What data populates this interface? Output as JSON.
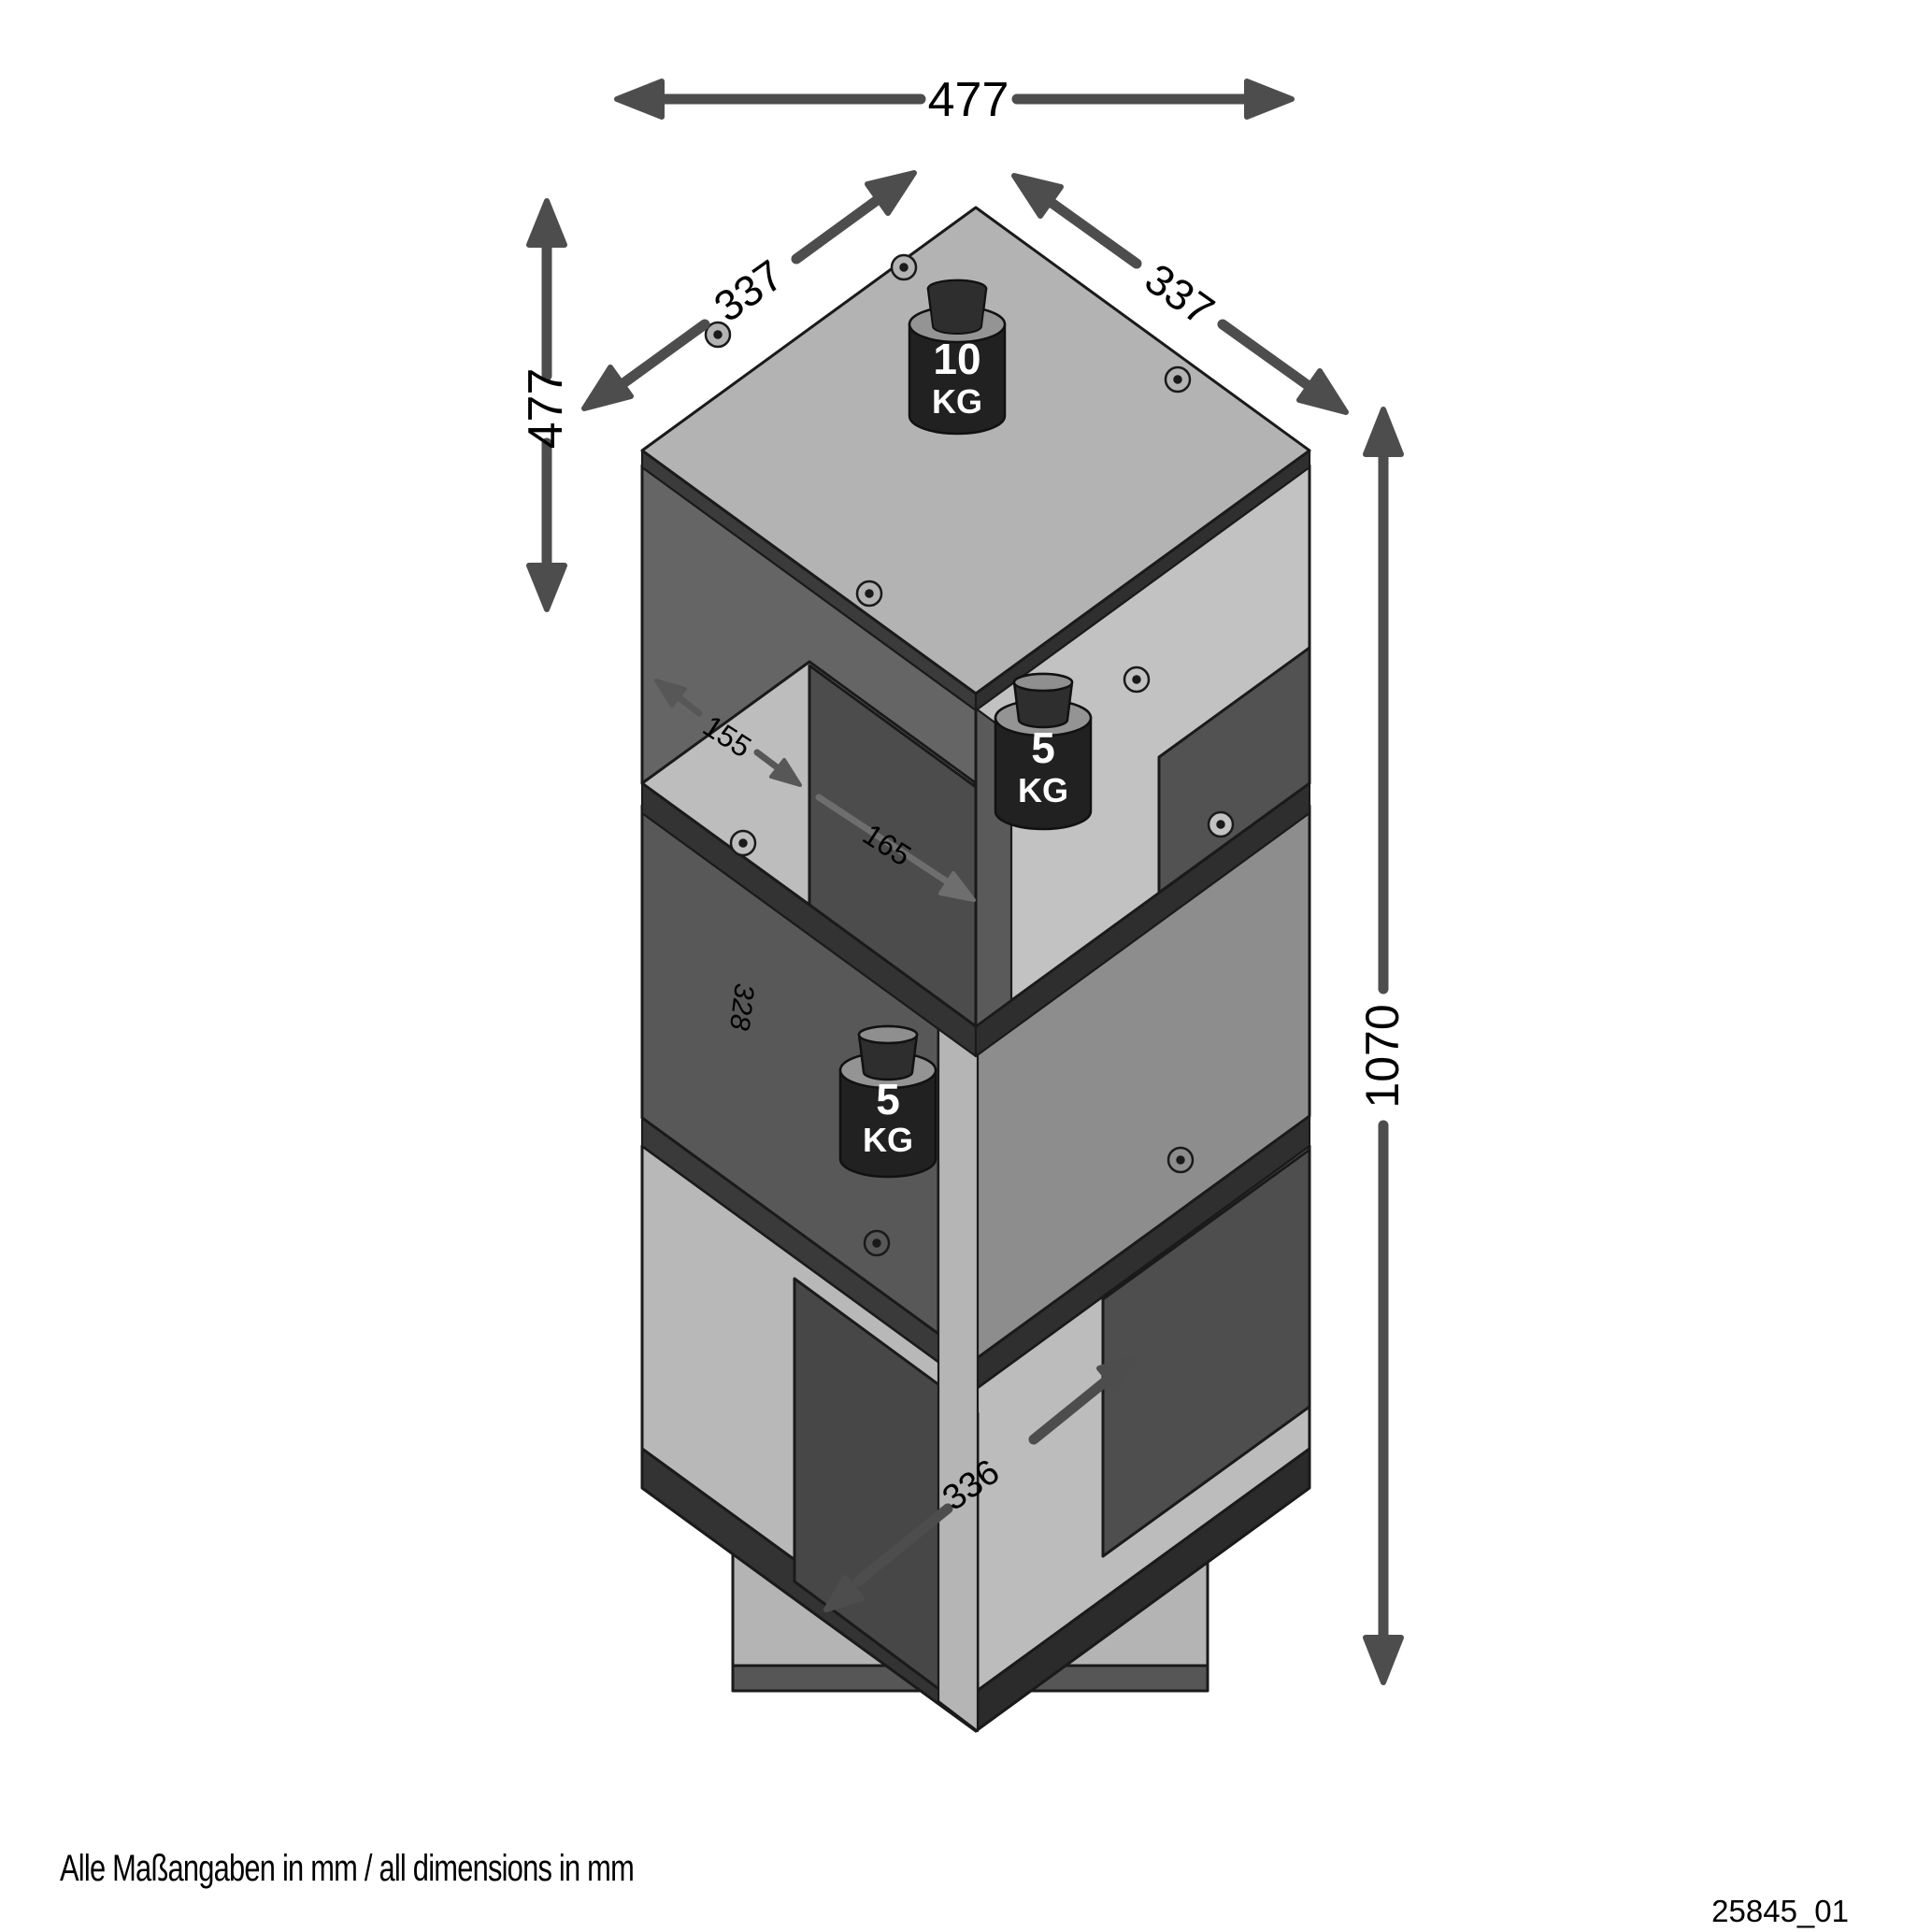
{
  "drawing": {
    "footer_left": "Alle Maßangaben in mm / all dimensions in mm",
    "footer_right": "25845_01"
  },
  "dimensions": {
    "top_width_mm": "477",
    "left_height_mm": "477",
    "left_depth_mm": "337",
    "right_depth_mm": "337",
    "total_height_mm": "1070",
    "compartment_width_left_mm": "155",
    "compartment_width_right_mm": "165",
    "compartment_height_mm": "328",
    "compartment_depth_mm": "336"
  },
  "load_capacities": {
    "top": {
      "value": "10",
      "unit": "KG"
    },
    "middle": {
      "value": "5",
      "unit": "KG"
    },
    "bottom": {
      "value": "5",
      "unit": "KG"
    }
  },
  "colors": {
    "background": "#ffffff",
    "dimension_arrows": "#4d4d4d",
    "label_text": "#000000",
    "panel_light": "#b3b3b3",
    "panel_medium": "#8d8d8d",
    "panel_dark": "#4e4e4e",
    "weight_body": "#212121",
    "weight_text": "#ffffff"
  }
}
